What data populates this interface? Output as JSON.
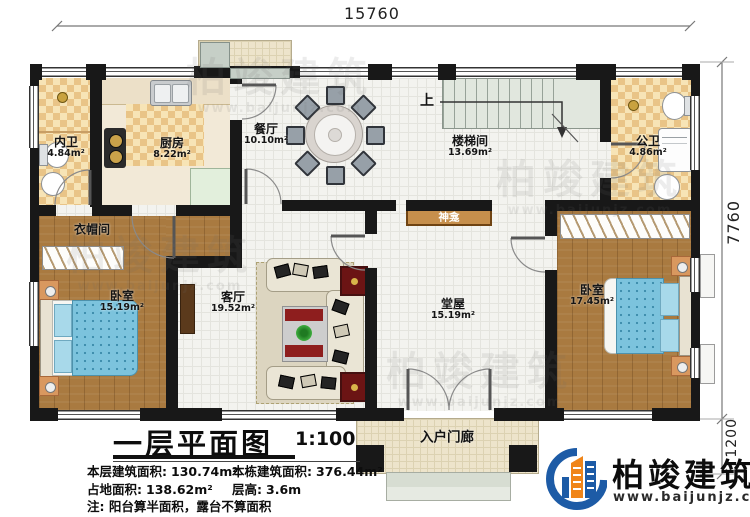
{
  "dims": {
    "top": "15760",
    "main_h": "7760",
    "porch_h": "1200"
  },
  "rooms": {
    "neiwei": {
      "name": "内卫",
      "area": "4.84m²"
    },
    "chufang": {
      "name": "厨房",
      "area": "8.22m²"
    },
    "canting": {
      "name": "餐厅",
      "area": "10.10m²"
    },
    "loutijian": {
      "name": "楼梯间",
      "area": "13.69m²"
    },
    "gongwei": {
      "name": "公卫",
      "area": "4.86m²"
    },
    "yimaojian": {
      "name": "衣帽间"
    },
    "bedroom_left": {
      "name": "卧室",
      "area": "15.19m²"
    },
    "keting": {
      "name": "客厅",
      "area": "19.52m²"
    },
    "shenkan": {
      "name": "神龛"
    },
    "tangwu": {
      "name": "堂屋",
      "area": "15.19m²"
    },
    "bedroom_right": {
      "name": "卧室",
      "area": "17.45m²"
    },
    "porch": {
      "name": "入户门廊"
    }
  },
  "stairs": {
    "up": "上"
  },
  "tb": {
    "title": "一层平面图",
    "scale": "1:100",
    "s1l": "本层建筑面积:",
    "s1v": "130.74m²",
    "s2l": "本栋建筑面积:",
    "s2v": "376.44m²",
    "s3l": "占地面积:",
    "s3v": "138.62m²",
    "s4l": "层高:",
    "s4v": "3.6m",
    "note": "注: 阳台算半面积，露台不算面积"
  },
  "logo": {
    "brand": "柏竣建筑",
    "site": "www.baijunjz.com"
  },
  "colors": {
    "wall": "#181818",
    "accent_blue": "#1d5ba6",
    "accent_orange": "#f08519",
    "bed_blue": "#7cc3dd",
    "wood": "#a97a40"
  }
}
